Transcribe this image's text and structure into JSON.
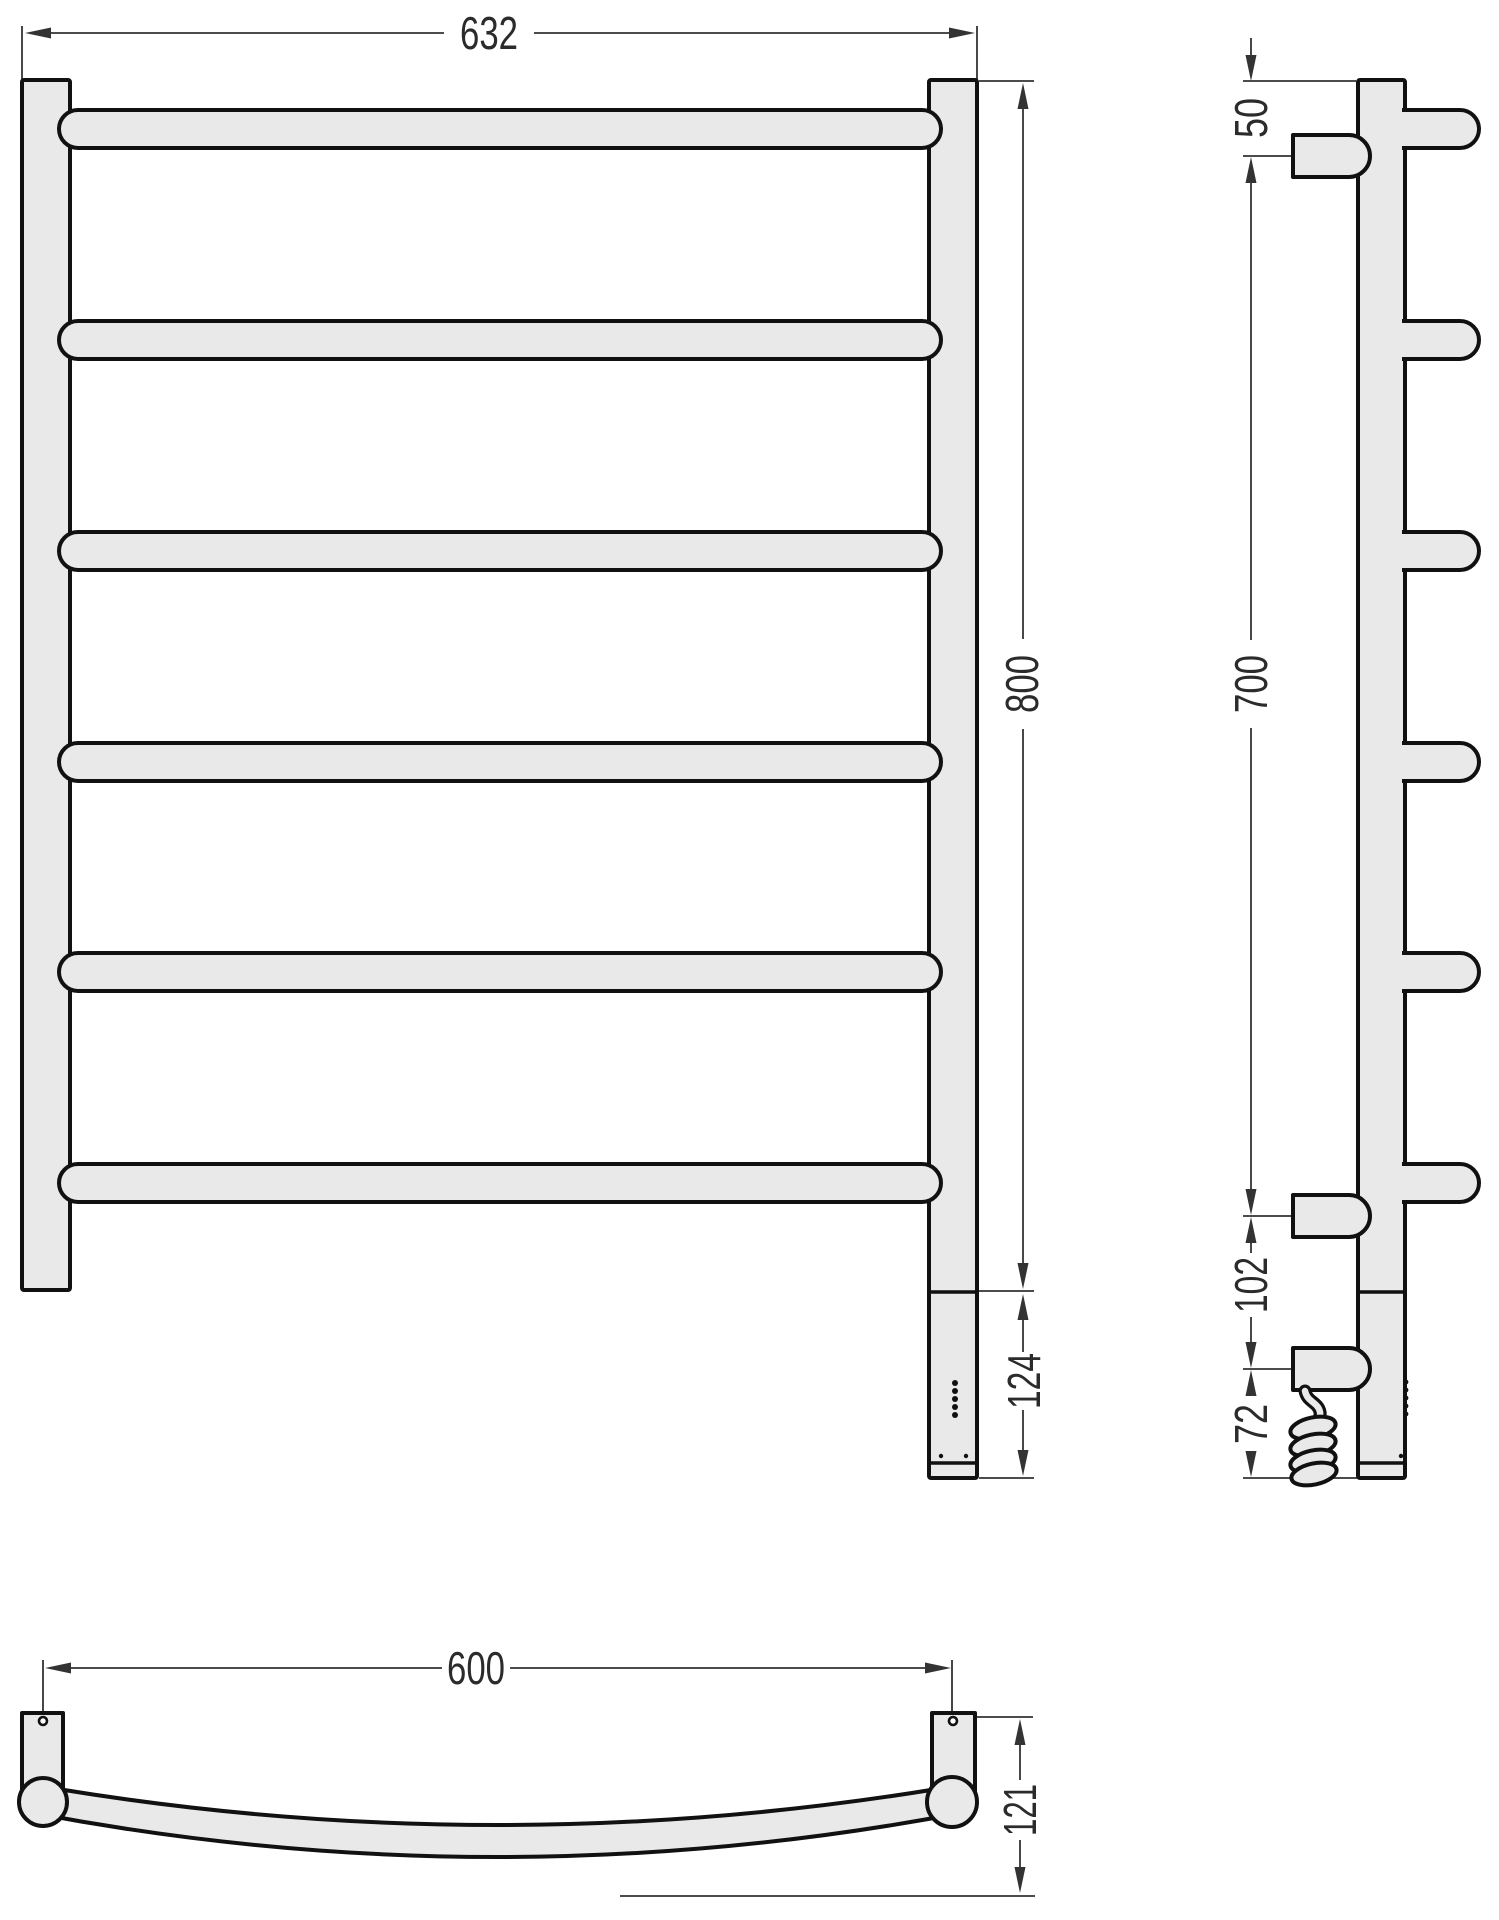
{
  "drawing_type": "towel-rail-technical-drawing",
  "colors": {
    "outline": "#111111",
    "fill": "#e9e9e9",
    "dimension_lines": "#333333",
    "background": "#ffffff"
  },
  "front_view": {
    "width": "632",
    "height": "800",
    "heater_section_height": "124",
    "bar_count": 6
  },
  "side_view": {
    "top_to_upper_bracket": "50",
    "bracket_span": "700",
    "lower_bracket_to_power_unit": "102",
    "power_unit_to_bottom": "72"
  },
  "bottom_view": {
    "mount_spacing": "600",
    "depth": "121"
  }
}
